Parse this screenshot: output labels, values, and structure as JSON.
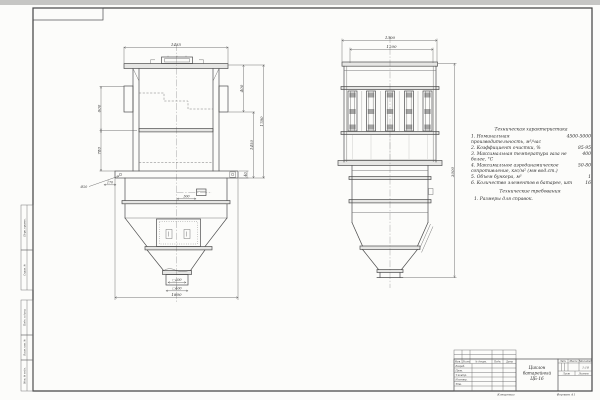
{
  "sheet": {
    "colors": {
      "paper": "#fcfcfa",
      "ink": "#4d4d4d",
      "scan_edge": "#c6c6c4"
    },
    "margin_stamps": {
      "upper": [
        "Перв. примен.",
        "Справ. №"
      ],
      "lower": [
        "Подп. и дата",
        "Взам. инв. №",
        "Инв. № подл."
      ]
    },
    "front_view": {
      "dim_width_top": "1435",
      "dim_left_upper": "600",
      "dim_left_lower": "780",
      "dim_right_inner": "400",
      "dim_right_mid": "1450",
      "dim_right_outer": "1780",
      "dim_bottom": "1800",
      "hole_note": "Ø20",
      "dim_overhang": "170",
      "dim_base": "40",
      "dim_nozzle_offset": "300",
      "outlet_inner": "□300",
      "outlet_outer": "□400"
    },
    "side_view": {
      "dim_width_outer": "1300",
      "dim_width_inner": "1200",
      "dim_height": "3000"
    },
    "tech_chars": {
      "title": "Техническая характеристика",
      "items": [
        {
          "label": "1. Номинальная производительность, м³/час",
          "value": "4500-5000"
        },
        {
          "label": "2. Коэффициент очистки, %",
          "value": "85-95"
        },
        {
          "label": "3. Максимальная температура газа не более, °C",
          "value": "400"
        },
        {
          "label": "4. Максимальное аэродинамическое сопротивление, кгс/м² (мм вод.ст.)",
          "value": "50-80"
        },
        {
          "label": "5. Объем бункера, м³",
          "value": "1"
        },
        {
          "label": "6. Количество элементов в батарее, шт",
          "value": "16"
        }
      ]
    },
    "tech_reqs": {
      "title": "Технические требования",
      "items": [
        {
          "label": "1. Размеры для справок."
        }
      ]
    },
    "title_block": {
      "rev_header": {
        "izm": "Изм.",
        "list": "Лист",
        "doc": "№ докум.",
        "podp": "Подп.",
        "data": "Дата"
      },
      "rows": [
        "Разраб.",
        "Пров.",
        "Т.контр.",
        "Н.контр.",
        "Утв."
      ],
      "name_lines": [
        "Циклон",
        "батарейный",
        "ЦБ-16"
      ],
      "lit": "Лит.",
      "massa": "Масса",
      "masshtab": "Масштаб",
      "scale": "1:10",
      "list_label": "Лист",
      "listov_label": "Листов",
      "kopiroval": "Копировал",
      "format": "Формат А1"
    }
  }
}
